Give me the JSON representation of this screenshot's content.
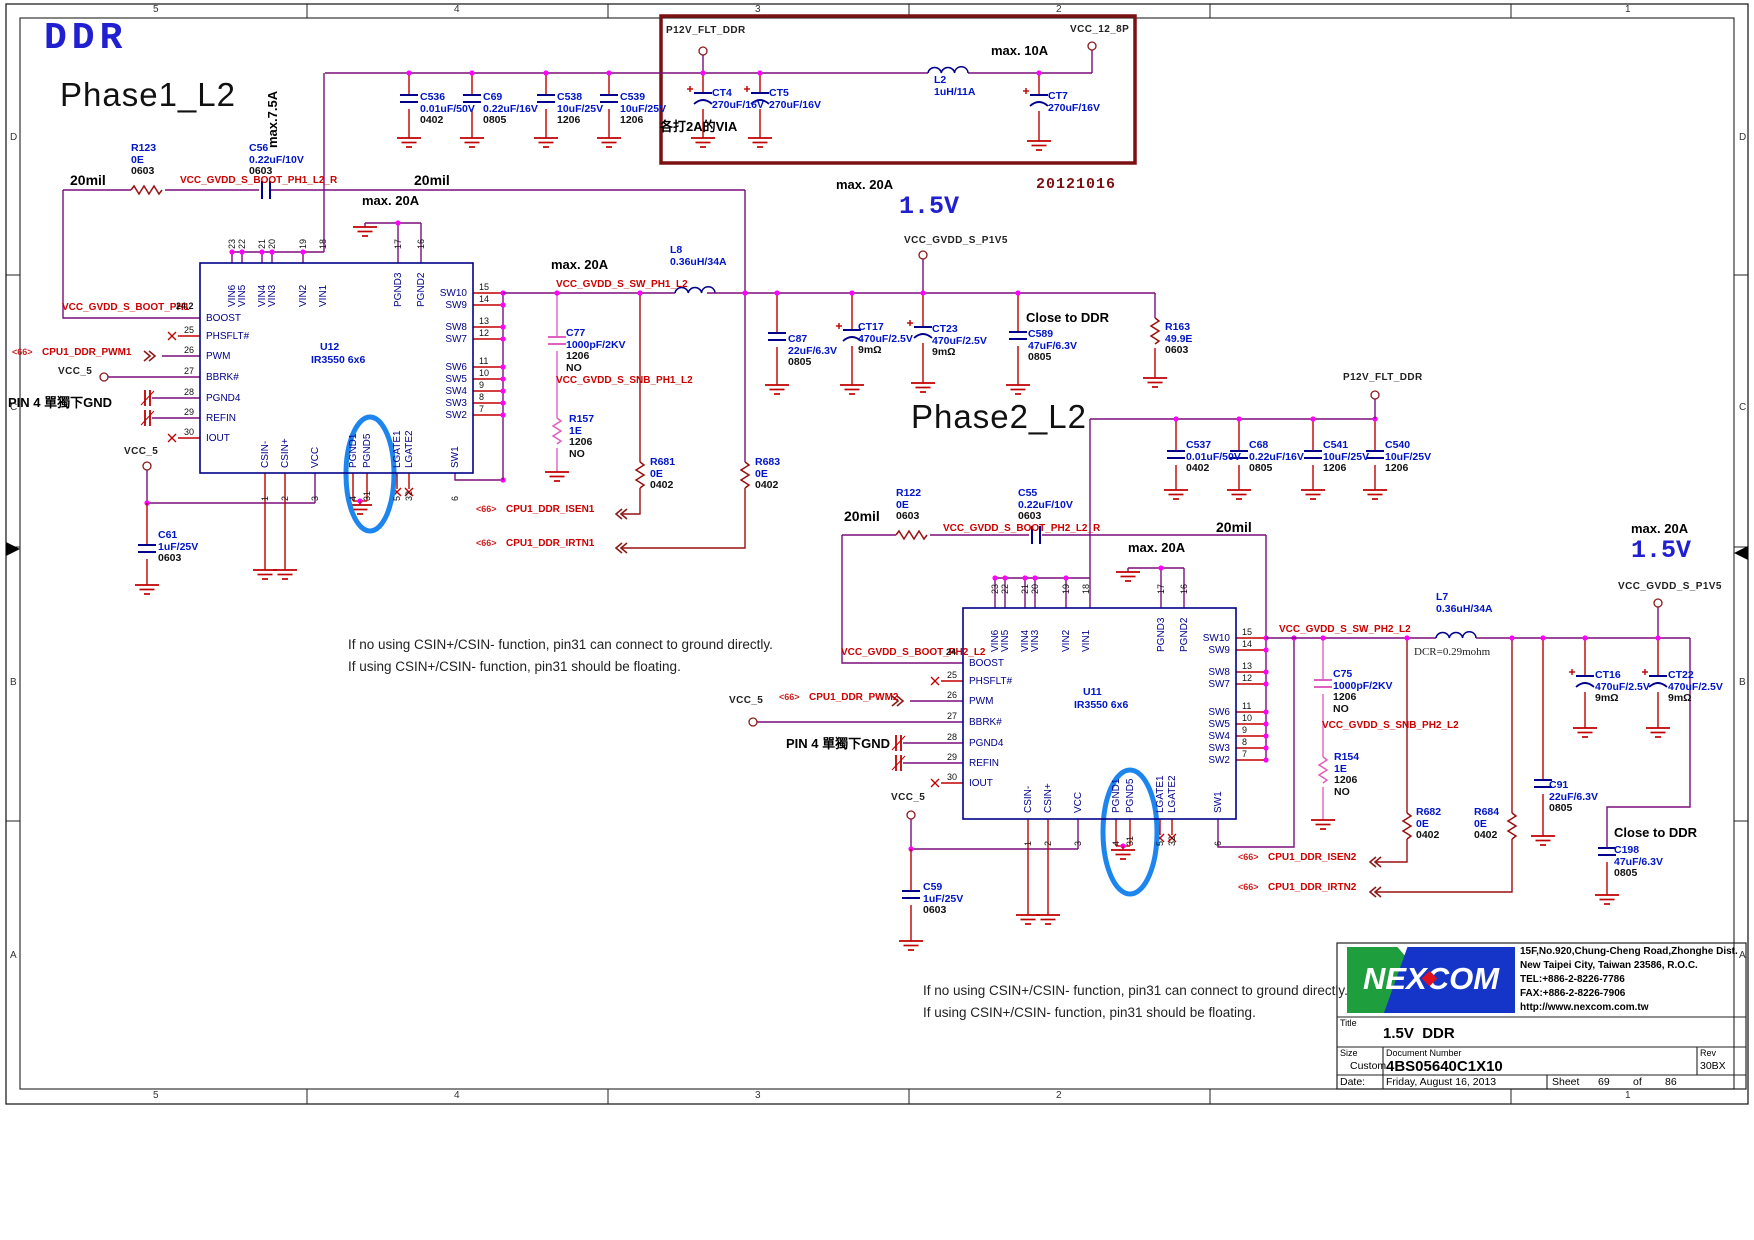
{
  "titles": {
    "ddr": "DDR",
    "phase1": "Phase1_L2",
    "phase2": "Phase2_L2",
    "datecode": "20121016",
    "v15": "1.5V"
  },
  "ann": {
    "max75": "max.7.5A",
    "max10": "max. 10A",
    "max20": "max. 20A",
    "mil20": "20mil",
    "via": "各打2A的VIA",
    "pin4": "PIN 4 單獨下GND",
    "note1": "If no using CSIN+/CSIN- function, pin31 can connect to ground directly.",
    "note2": "If using CSIN+/CSIN- function, pin31 should be floating.",
    "dcr": "DCR=0.29mohm",
    "close": "Close to DDR",
    "ref66": "<66>"
  },
  "ports": {
    "p12v": "P12V_FLT_DDR",
    "vcc12": "VCC_12_8P",
    "p1v5": "VCC_GVDD_S_P1V5",
    "vcc5": "VCC_5"
  },
  "nets": {
    "boot1r": "VCC_GVDD_S_BOOT_PH1_L2_R",
    "boot1": "VCC_GVDD_S_BOOT_PH1",
    "boot1pin": "24.2",
    "boot2r": "VCC_GVDD_S_BOOT_PH2_L2_R",
    "boot2": "VCC_GVDD_S_BOOT_PH2_L2",
    "boot2pin": "24",
    "swph1": "VCC_GVDD_S_SW_PH1_L2",
    "swph2": "VCC_GVDD_S_SW_PH2_L2",
    "snb1": "VCC_GVDD_S_SNB_PH1_L2",
    "snb2": "VCC_GVDD_S_SNB_PH2_L2",
    "pwm1": "CPU1_DDR_PWM1",
    "pwm2": "CPU1_DDR_PWM2",
    "isen1": "CPU1_DDR_ISEN1",
    "irtn1": "CPU1_DDR_IRTN1",
    "isen2": "CPU1_DDR_ISEN2",
    "irtn2": "CPU1_DDR_IRTN2"
  },
  "components": {
    "c536": {
      "ref": "C536",
      "val": "0.01uF/50V",
      "fp": "0402"
    },
    "c69": {
      "ref": "C69",
      "val": "0.22uF/16V",
      "fp": "0805"
    },
    "c538": {
      "ref": "C538",
      "val": "10uF/25V",
      "fp": "1206"
    },
    "c539": {
      "ref": "C539",
      "val": "10uF/25V",
      "fp": "1206"
    },
    "ct4": {
      "ref": "CT4",
      "val": "270uF/16V"
    },
    "ct5": {
      "ref": "CT5",
      "val": "270uF/16V"
    },
    "ct7": {
      "ref": "CT7",
      "val": "270uF/16V"
    },
    "l2": {
      "ref": "L2",
      "val": "1uH/11A"
    },
    "r123": {
      "ref": "R123",
      "val": "0E",
      "fp": "0603"
    },
    "c56": {
      "ref": "C56",
      "val": "0.22uF/10V",
      "fp": "0603"
    },
    "c61": {
      "ref": "C61",
      "val": "1uF/25V",
      "fp": "0603"
    },
    "l8": {
      "ref": "L8",
      "val": "0.36uH/34A"
    },
    "c77": {
      "ref": "C77",
      "val": "1000pF/2KV",
      "fp": "1206",
      "no": "NO"
    },
    "r157": {
      "ref": "R157",
      "val": "1E",
      "fp": "1206",
      "no": "NO"
    },
    "r681": {
      "ref": "R681",
      "val": "0E",
      "fp": "0402"
    },
    "r683": {
      "ref": "R683",
      "val": "0E",
      "fp": "0402"
    },
    "c87": {
      "ref": "C87",
      "val": "22uF/6.3V",
      "fp": "0805"
    },
    "ct17": {
      "ref": "CT17",
      "val": "470uF/2.5V",
      "fp": "9mΩ"
    },
    "ct23": {
      "ref": "CT23",
      "val": "470uF/2.5V",
      "fp": "9mΩ"
    },
    "c589": {
      "ref": "C589",
      "val": "47uF/6.3V",
      "fp": "0805"
    },
    "r163": {
      "ref": "R163",
      "val": "49.9E",
      "fp": "0603"
    },
    "c537": {
      "ref": "C537",
      "val": "0.01uF/50V",
      "fp": "0402"
    },
    "c68": {
      "ref": "C68",
      "val": "0.22uF/16V",
      "fp": "0805"
    },
    "c541": {
      "ref": "C541",
      "val": "10uF/25V",
      "fp": "1206"
    },
    "c540": {
      "ref": "C540",
      "val": "10uF/25V",
      "fp": "1206"
    },
    "r122": {
      "ref": "R122",
      "val": "0E",
      "fp": "0603"
    },
    "c55": {
      "ref": "C55",
      "val": "0.22uF/10V",
      "fp": "0603"
    },
    "c59": {
      "ref": "C59",
      "val": "1uF/25V",
      "fp": "0603"
    },
    "l7": {
      "ref": "L7",
      "val": "0.36uH/34A"
    },
    "c75": {
      "ref": "C75",
      "val": "1000pF/2KV",
      "fp": "1206",
      "no": "NO"
    },
    "r154": {
      "ref": "R154",
      "val": "1E",
      "fp": "1206",
      "no": "NO"
    },
    "r682": {
      "ref": "R682",
      "val": "0E",
      "fp": "0402"
    },
    "r684": {
      "ref": "R684",
      "val": "0E",
      "fp": "0402"
    },
    "c91": {
      "ref": "C91",
      "val": "22uF/6.3V",
      "fp": "0805"
    },
    "ct16": {
      "ref": "CT16",
      "val": "470uF/2.5V",
      "fp": "9mΩ"
    },
    "ct22": {
      "ref": "CT22",
      "val": "470uF/2.5V",
      "fp": "9mΩ"
    },
    "c198": {
      "ref": "C198",
      "val": "47uF/6.3V",
      "fp": "0805"
    }
  },
  "ic": {
    "u12": "U12",
    "u11": "U11",
    "part": "IR3550 6x6",
    "left_pins": [
      {
        "num": "24",
        "name": "BOOST"
      },
      {
        "num": "25",
        "name": "PHSFLT#"
      },
      {
        "num": "26",
        "name": "PWM"
      },
      {
        "num": "27",
        "name": "BBRK#"
      },
      {
        "num": "28",
        "name": "PGND4"
      },
      {
        "num": "29",
        "name": "REFIN"
      },
      {
        "num": "30",
        "name": "IOUT"
      }
    ],
    "top_pins": [
      {
        "num": "23",
        "name": "VIN6"
      },
      {
        "num": "22",
        "name": "VIN5"
      },
      {
        "num": "21",
        "name": "VIN4"
      },
      {
        "num": "20",
        "name": "VIN3"
      },
      {
        "num": "19",
        "name": "VIN2"
      },
      {
        "num": "18",
        "name": "VIN1"
      },
      {
        "num": "17",
        "name": "PGND3"
      },
      {
        "num": "16",
        "name": "PGND2"
      }
    ],
    "right_pins": [
      {
        "num": "15",
        "name": "SW10"
      },
      {
        "num": "14",
        "name": "SW9"
      },
      {
        "num": "13",
        "name": "SW8"
      },
      {
        "num": "12",
        "name": "SW7"
      },
      {
        "num": "11",
        "name": "SW6"
      },
      {
        "num": "10",
        "name": "SW5"
      },
      {
        "num": "9",
        "name": "SW4"
      },
      {
        "num": "8",
        "name": "SW3"
      },
      {
        "num": "7",
        "name": "SW2"
      }
    ],
    "bottom_pins": [
      {
        "num": "1",
        "name": "CSIN-"
      },
      {
        "num": "2",
        "name": "CSIN+"
      },
      {
        "num": "3",
        "name": "VCC"
      },
      {
        "num": "4",
        "name": "PGND1"
      },
      {
        "num": "31",
        "name": "PGND5"
      },
      {
        "num": "5",
        "name": "LGATE1"
      },
      {
        "num": "32",
        "name": "LGATE2"
      },
      {
        "num": "6",
        "name": "SW1"
      }
    ]
  },
  "tb": {
    "logo": "NEXCOM",
    "addr1": "15F,No.920,Chung-Cheng Road,Zhonghe Dist.",
    "addr2": "New Taipei City, Taiwan 23586, R.O.C.",
    "tel": "TEL:+886-2-8226-7786",
    "fax": "FAX:+886-2-8226-7906",
    "url": "http://www.nexcom.com.tw",
    "title_label": "Title",
    "title": "1.5V  DDR",
    "size_label": "Size",
    "size_value": "Custom",
    "doc_label": "Document Number",
    "doc": "4BS05640C1X10",
    "rev_label": "Rev",
    "rev": "30BX",
    "date_label": "Date:",
    "date": "Friday, August 16, 2013",
    "sheet_label": "Sheet",
    "sheet_no": "69",
    "of_label": "of",
    "sheet_total": "86"
  },
  "grid": {
    "cols": [
      "5",
      "4",
      "3",
      "2",
      "1"
    ],
    "rows": [
      "D",
      "C",
      "B",
      "A"
    ]
  }
}
